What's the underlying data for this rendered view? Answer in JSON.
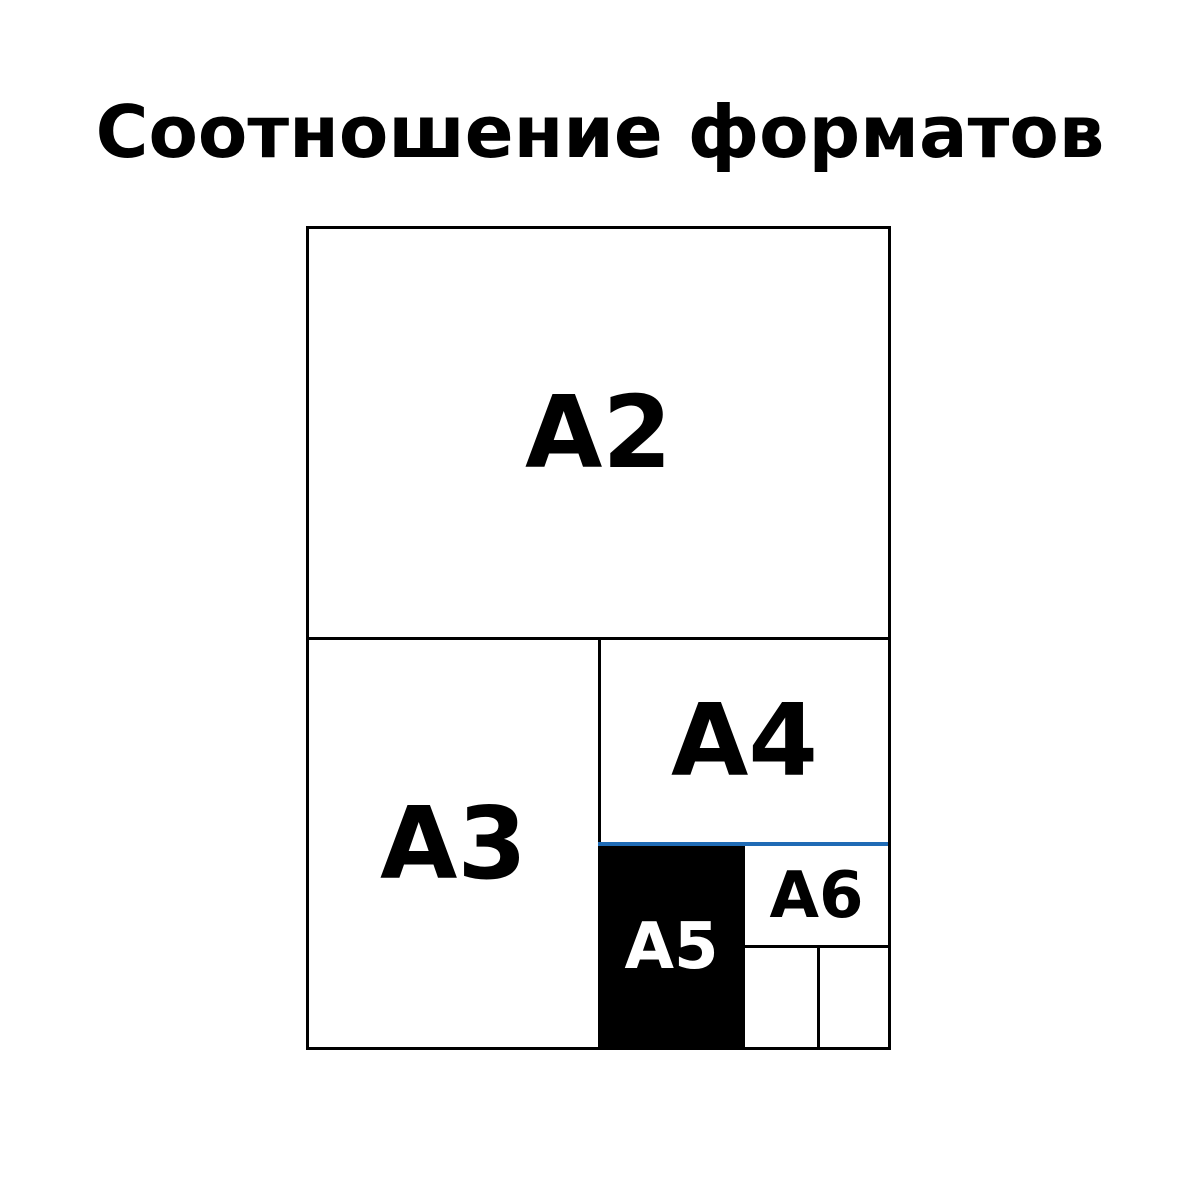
{
  "title": "Соотношение форматов",
  "diagram": {
    "labels": {
      "a2": "A2",
      "a3": "A3",
      "a4": "A4",
      "a5": "A5",
      "a6": "A6"
    },
    "colors": {
      "background": "#ffffff",
      "line": "#000000",
      "highlight_line": "#1f6bb5",
      "a5_fill": "#000000",
      "a5_label": "#ffffff"
    }
  }
}
